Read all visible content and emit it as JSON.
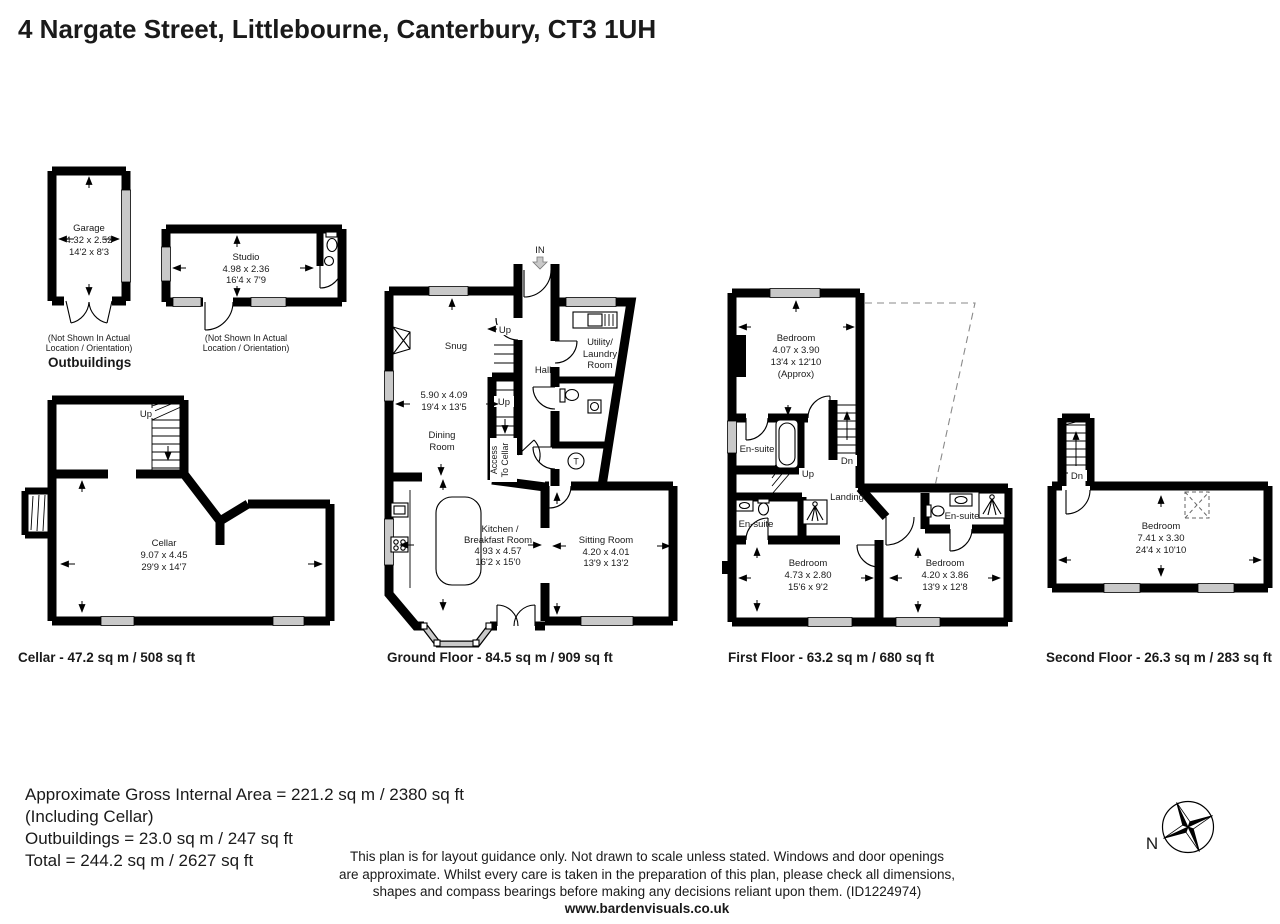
{
  "title": "4 Nargate Street, Littlebourne, Canterbury, CT3 1UH",
  "outbuildings": {
    "heading": "Outbuildings",
    "note1": "(Not Shown In Actual",
    "note2": "Location / Orientation)",
    "garage": {
      "name": "Garage",
      "m": "4.32 x 2.52",
      "ft": "14'2 x 8'3"
    },
    "studio": {
      "name": "Studio",
      "m": "4.98 x 2.36",
      "ft": "16'4 x 7'9"
    }
  },
  "cellar": {
    "label": "Cellar - 47.2 sq m / 508 sq ft",
    "up": "Up",
    "room": {
      "name": "Cellar",
      "m": "9.07 x 4.45",
      "ft": "29'9 x 14'7"
    }
  },
  "ground": {
    "label": "Ground Floor - 84.5 sq m / 909 sq ft",
    "in_label": "IN",
    "up1": "Up",
    "up2": "Up",
    "access1": "Access",
    "access2": "To Cellar",
    "hall": "Hall",
    "t": "T",
    "snug": {
      "name": "Snug",
      "m": "5.90 x 4.09",
      "ft": "19'4 x 13'5"
    },
    "dining": {
      "line1": "Dining",
      "line2": "Room"
    },
    "utility": {
      "line1": "Utility/",
      "line2": "Laundry",
      "line3": "Room"
    },
    "kitchen": {
      "line1": "Kitchen /",
      "line2": "Breakfast Room",
      "m": "4.93 x 4.57",
      "ft": "16'2 x 15'0"
    },
    "sitting": {
      "name": "Sitting Room",
      "m": "4.20 x 4.01",
      "ft": "13'9 x 13'2"
    }
  },
  "first": {
    "label": "First Floor - 63.2 sq m / 680 sq ft",
    "up": "Up",
    "dn": "Dn",
    "landing": "Landing",
    "ensuite1": "En-suite",
    "ensuite2": "En-suite",
    "ensuite3": "En-suite",
    "bedroom1": {
      "name": "Bedroom",
      "m": "4.07 x 3.90",
      "ft": "13'4 x 12'10",
      "approx": "(Approx)"
    },
    "bedroom2": {
      "name": "Bedroom",
      "m": "4.73 x 2.80",
      "ft": "15'6 x 9'2"
    },
    "bedroom3": {
      "name": "Bedroom",
      "m": "4.20 x 3.86",
      "ft": "13'9 x 12'8"
    }
  },
  "second": {
    "label": "Second Floor - 26.3 sq m / 283 sq ft",
    "dn": "Dn",
    "bedroom": {
      "name": "Bedroom",
      "m": "7.41 x 3.30",
      "ft": "24'4 x 10'10"
    }
  },
  "footer": {
    "area_line1": "Approximate Gross Internal Area = 221.2 sq m / 2380 sq ft",
    "area_line2": "(Including Cellar)",
    "area_line3": "Outbuildings = 23.0 sq m / 247 sq ft",
    "area_line4": "Total = 244.2 sq m / 2627 sq ft",
    "disclaimer1": "This plan is for layout guidance only. Not drawn to scale unless stated. Windows and door openings",
    "disclaimer2": "are approximate. Whilst every care is taken in the preparation of this plan, please check all dimensions,",
    "disclaimer3": "shapes and compass bearings before making any decisions reliant upon them. (ID1224974)",
    "website": "www.bardenvisuals.co.uk",
    "compass_n": "N"
  },
  "colors": {
    "wall": "#000000",
    "window": "#c9c9c9",
    "dashed_void": "#8a8a8a"
  }
}
